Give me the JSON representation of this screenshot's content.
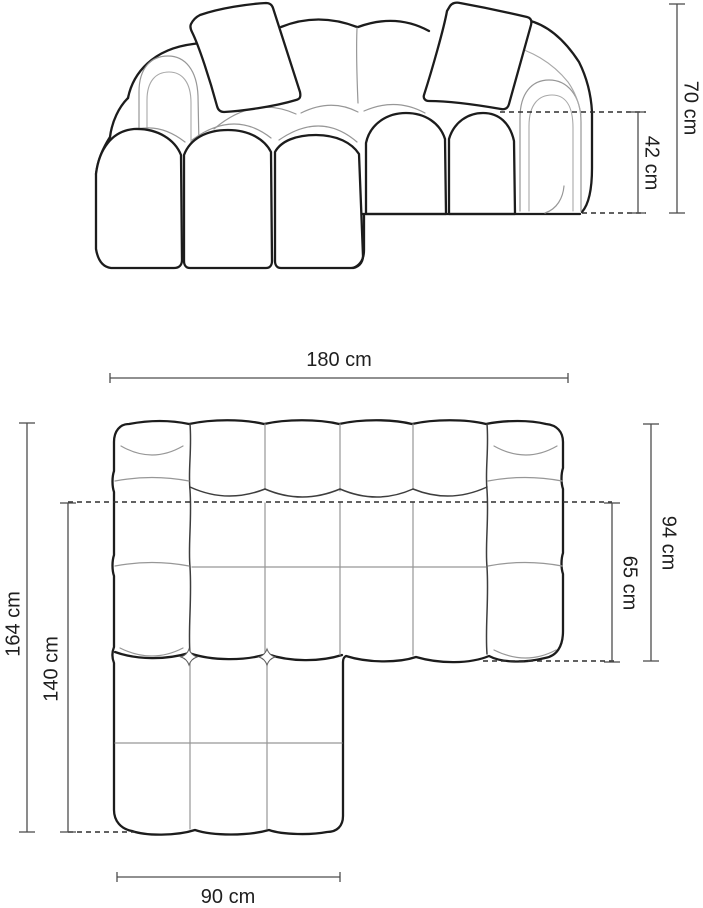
{
  "diagram": {
    "subject": "corner sofa dimension drawing",
    "views": [
      {
        "id": "front",
        "name": "front elevation"
      },
      {
        "id": "top",
        "name": "top plan"
      }
    ]
  },
  "labels": {
    "total_height": "70 cm",
    "seat_height": "42 cm",
    "total_width": "180 cm",
    "total_depth": "94 cm",
    "seat_depth": "65 cm",
    "total_length": "164 cm",
    "chaise_length": "140 cm",
    "chaise_width": "90 cm"
  },
  "colors": {
    "outline": "#1c1c1c",
    "seam": "#979797",
    "dimension_line": "#4d4d4d",
    "dashed_line": "#2e2e2e",
    "label_text": "#1f1f1f",
    "background": "#ffffff"
  }
}
